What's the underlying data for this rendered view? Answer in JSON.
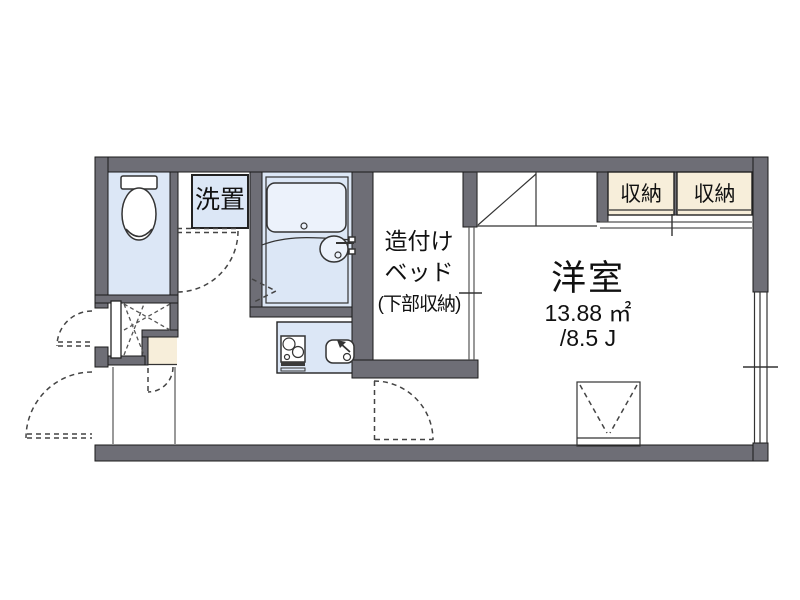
{
  "title": "apartment-floorplan",
  "colors": {
    "wall": "#6e6e76",
    "wet_area": "#dce7f6",
    "tub": "#ecf2fb",
    "closet": "#f7eeda",
    "text": "#111111"
  },
  "rooms": {
    "washer_space": {
      "label": "洗置"
    },
    "built_in_bed": {
      "line1": "造付け",
      "line2": "ベッド",
      "line3": "(下部収納)"
    },
    "western_room": {
      "name": "洋室",
      "area_sqm": "13.88 ㎡",
      "area_jo": "/8.5 J"
    },
    "closet_left": {
      "label": "収納"
    },
    "closet_right": {
      "label": "収納"
    }
  },
  "icons": [
    "toilet-icon",
    "bathtub-icon",
    "washbasin-icon",
    "stove-icon",
    "kitchen-sink-icon",
    "loft-ladder-icon",
    "door-swing-arc",
    "folding-door-icon",
    "window-icon"
  ]
}
